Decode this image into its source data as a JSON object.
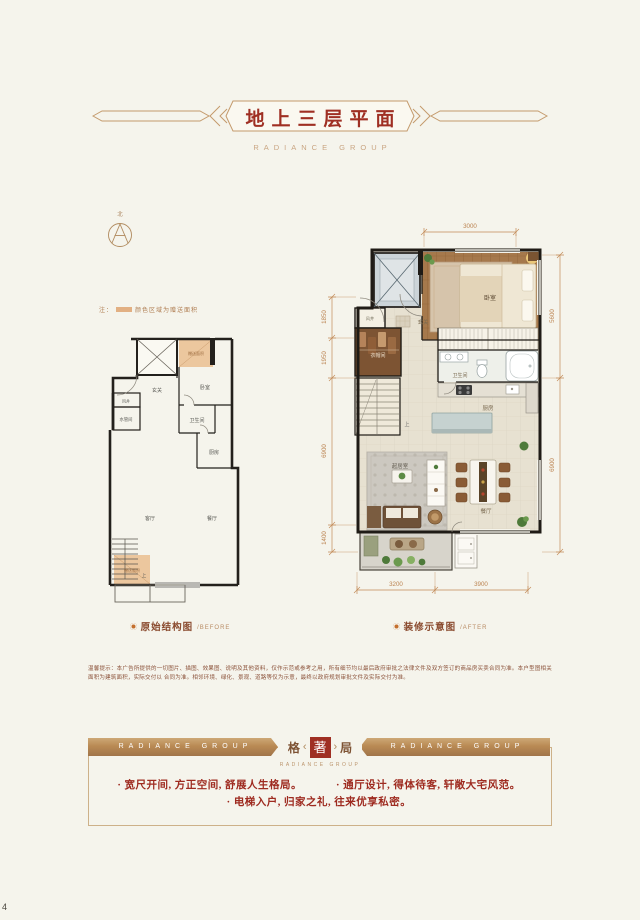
{
  "page": {
    "number": "4"
  },
  "header": {
    "title": "地上三层平面",
    "brand": "RADIANCE GROUP"
  },
  "compass": {
    "north": "北"
  },
  "legend": {
    "prefix": "注：",
    "text": "颜色区域为赠送面积"
  },
  "plans": {
    "before": {
      "caption": "原始结构图",
      "caption_en": "/BEFORE",
      "rooms": {
        "hall": "玄关",
        "bedroom": "卧室",
        "shaft": "风井",
        "pipe": "水管间",
        "bath": "卫生间",
        "kitchen": "厨房",
        "living": "客厅",
        "dining": "餐厅",
        "gift_top": "赠送面积",
        "gift_bottom": "赠送面积",
        "up": "上"
      }
    },
    "after": {
      "caption": "装修示意图",
      "caption_en": "/AFTER",
      "rooms": {
        "bedroom": "卧室",
        "hall": "玄关",
        "shaft": "风井",
        "cloak": "衣帽间",
        "bath": "卫生间",
        "kitchen": "厨房",
        "living": "起居室",
        "dining": "餐厅",
        "up": "上"
      },
      "dims": {
        "top": "3000",
        "left": [
          "1850",
          "1950",
          "6900",
          "1400"
        ],
        "right": [
          "5600",
          "6900"
        ],
        "bottom": [
          "3200",
          "3900"
        ]
      }
    }
  },
  "disclaimer": {
    "line1": "温馨提示：本广告所提供的一切图片、描图、效果图、说明及其他资料，仅作示范或参考之用，所有细节均以最后政府审批之法律文件及双方签订的商品房买卖合同为准。本户型图相关面积为建筑面积，实际交付以",
    "line2": "合同为准。相邻环境、绿化、景观、道路等仅为示意，最终以政府规划审批文件及实际交付为准。"
  },
  "footer": {
    "banner_left": "RADIANCE GROUP",
    "banner_right": "RADIANCE GROUP",
    "logo": {
      "left": "格",
      "seal": "著",
      "right": "局",
      "sub": "RADIANCE GROUP"
    },
    "bullets": [
      "宽尺开间, 方正空间, 舒展人生格局。",
      "通厅设计, 得体待客, 轩敞大宅风范。",
      "电梯入户, 归家之礼, 往来优享私密。"
    ]
  }
}
